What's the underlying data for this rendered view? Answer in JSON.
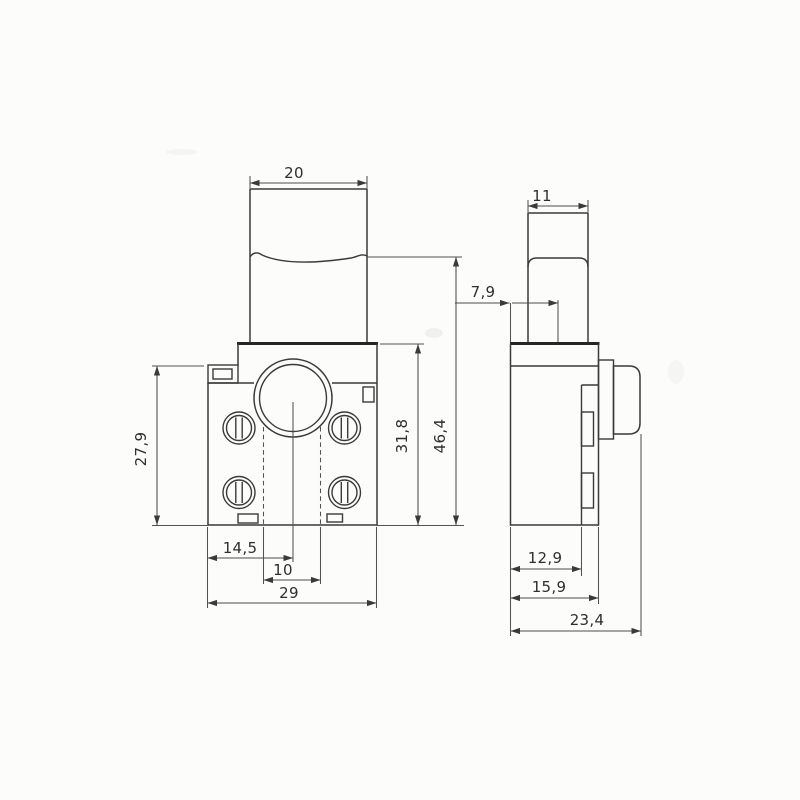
{
  "document": {
    "type": "technical dimension drawing",
    "subject": "trigger switch, front and side orthographic views",
    "units": "mm"
  },
  "front_view": {
    "label": "front view",
    "dimensions": {
      "trigger_width": "20",
      "left_body_height": "27,9",
      "body_height": "31,8",
      "overall_height": "46,4",
      "center_offset": "14,5",
      "contact_pitch": "10",
      "body_width": "29"
    }
  },
  "side_view": {
    "label": "side view",
    "dimensions": {
      "button_width": "11",
      "plunger_offset": "7,9",
      "contact_depth": "12,9",
      "body_depth": "15,9",
      "overall_depth": "23,4"
    }
  },
  "colors": {
    "background": "#fcfcfa",
    "outline": "#3a3a3a",
    "dimension_line": "#4e4b47",
    "text": "#2e2e2e"
  }
}
